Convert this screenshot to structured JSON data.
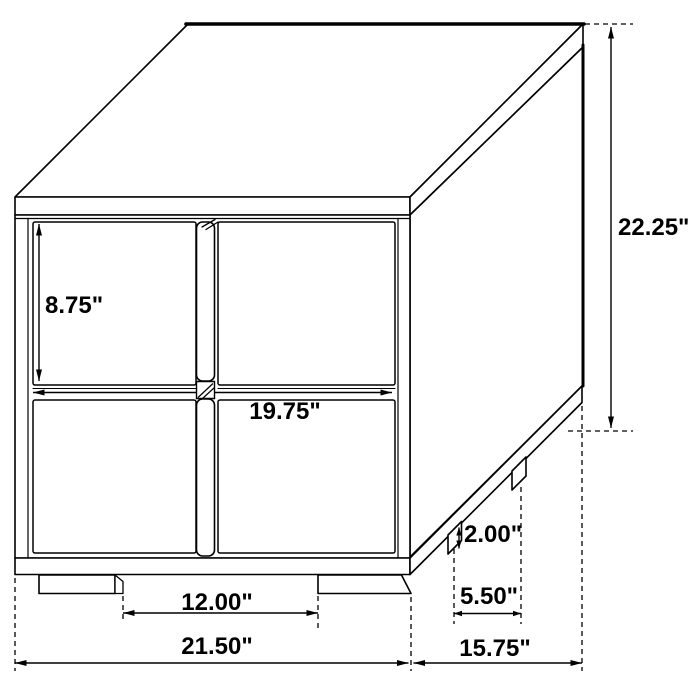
{
  "diagram": {
    "type": "furniture-dimension-drawing",
    "subject": "two-drawer nightstand, isometric line drawing",
    "units": "inches",
    "line_color": "#000000",
    "background_color": "#ffffff",
    "dimensions": {
      "overall_height": "22.25\"",
      "drawer_face_height": "8.75\"",
      "drawer_width": "19.75\"",
      "leg_height": "2.00\"",
      "side_leg_spacing": "5.50\"",
      "front_leg_spacing": "12.00\"",
      "overall_width": "21.50\"",
      "overall_depth": "15.75\""
    }
  }
}
